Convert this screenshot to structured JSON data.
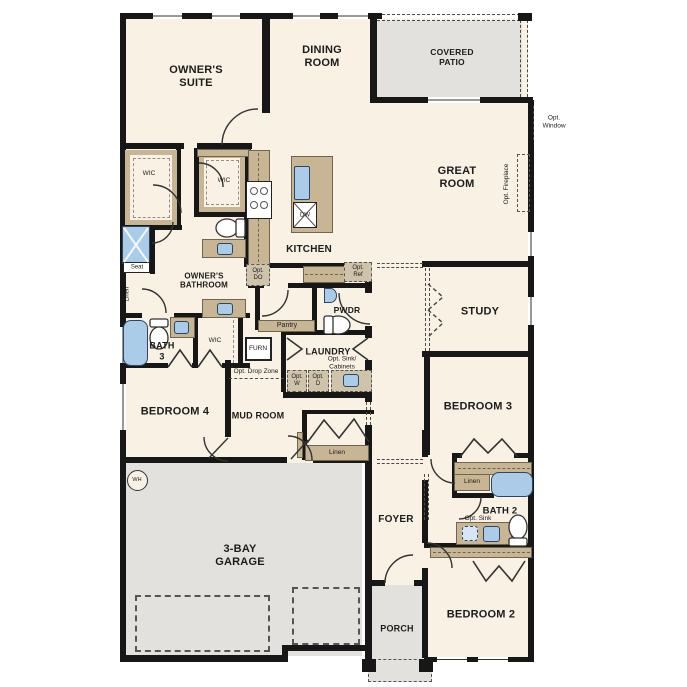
{
  "colors": {
    "floor": "#f8f1e4",
    "zone": "#e2e1dd",
    "wall": "#171717",
    "cabinet": "#c7b593",
    "fixture": "#abcce8"
  },
  "labels": {
    "owners_suite": "OWNER'S\nSUITE",
    "dining_room": "DINING\nROOM",
    "covered_patio": "COVERED\nPATIO",
    "great_room": "GREAT\nROOM",
    "opt_window": "Opt.\nWindow",
    "opt_fireplace": "Opt. Fireplace",
    "kitchen": "KITCHEN",
    "wic_1": "WIC",
    "wic_2": "WIC",
    "wic_3": "WIC",
    "owners_bathroom": "OWNER'S\nBATHROOM",
    "seat": "Seat",
    "linen_owner": "Linen",
    "bath_3": "BATH\n3",
    "furn": "FURN",
    "bedroom_4": "BEDROOM 4",
    "opt_drop_zone": "Opt. Drop Zone",
    "mud_room": "MUD ROOM",
    "pantry": "Pantry",
    "pwdr": "PWDR",
    "laundry": "LAUNDRY",
    "opt_sink_cabinets": "Opt. Sink/\nCabinets",
    "opt_w": "Opt.\nW",
    "opt_d": "Opt.\nD",
    "opt_do": "Opt.\nDO",
    "opt_ref": "Opt.\nRef",
    "dw": "DW",
    "study": "STUDY",
    "bedroom_3": "BEDROOM 3",
    "linen_hall": "Linen",
    "linen_bath2": "Linen",
    "bath_2": "BATH 2",
    "opt_sink": "Opt. Sink",
    "bedroom_2": "BEDROOM 2",
    "foyer": "FOYER",
    "porch": "PORCH",
    "garage": "3-BAY\nGARAGE",
    "wh": "WH"
  }
}
